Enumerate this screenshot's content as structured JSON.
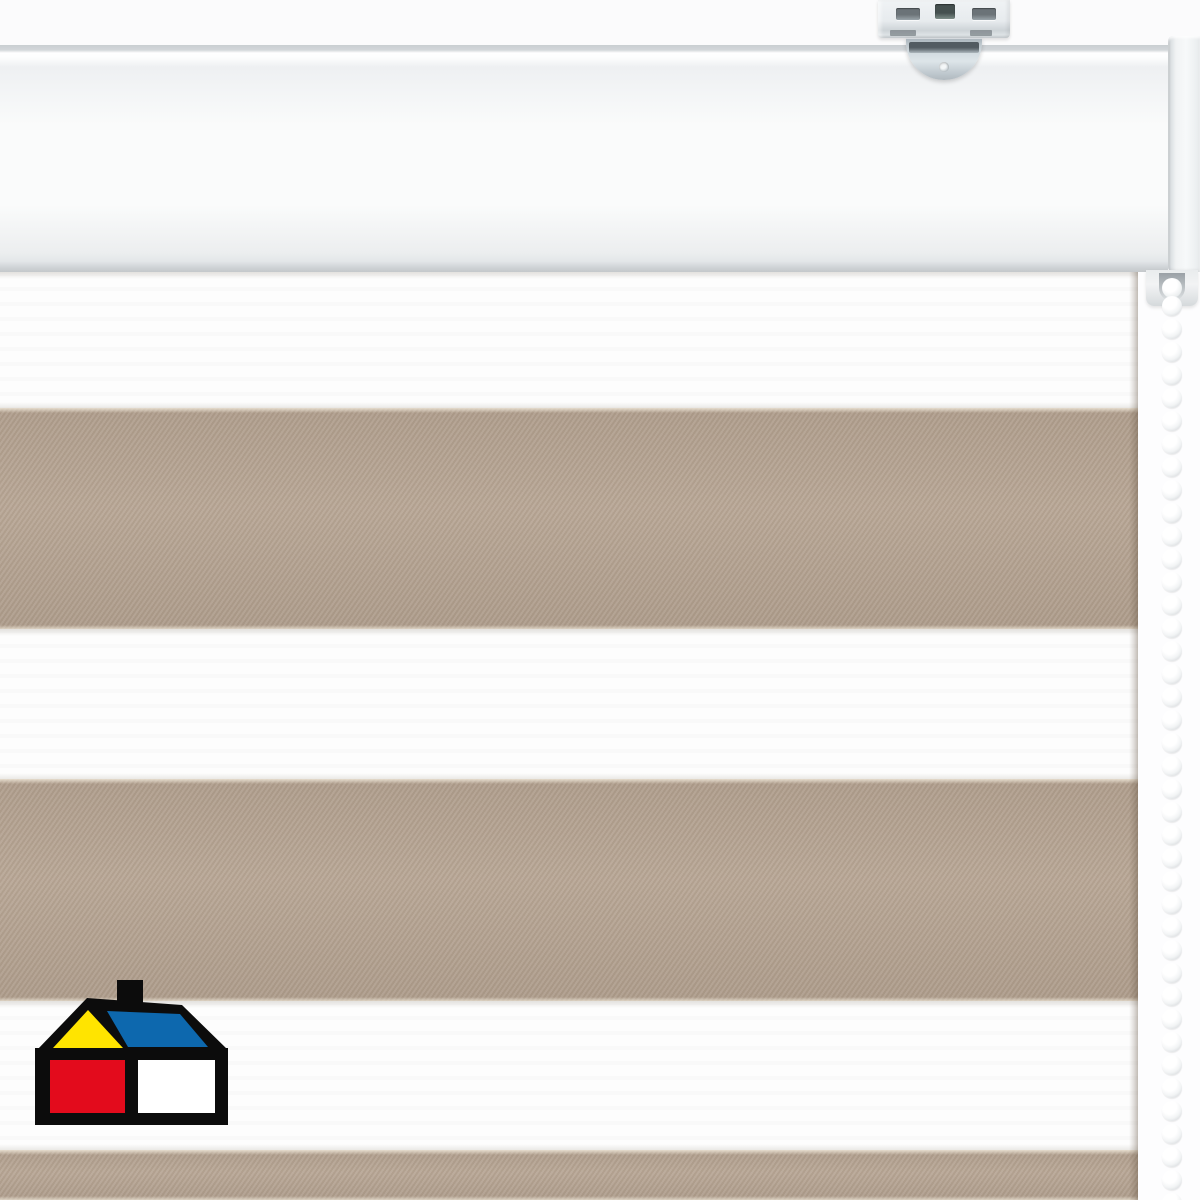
{
  "scene": {
    "subject": "Day-night zebra roller blind with beige and white horizontal stripes, white cassette headrail, metal ceiling-mount bracket, white bead chain and brand house logo at bottom left",
    "background_color": "#fdfdfe",
    "wall_color": "#fbfbfc"
  },
  "headrail": {
    "top_edge_color": "#c9ced1",
    "face_top_color": "#eef0f2",
    "face_mid_color": "#fafbfb",
    "face_bottom_color": "#eceeef",
    "bottom_lip_color": "#cdd1d4",
    "end_cap_color": "#f1f3f4",
    "end_cap_seam_color": "#b9bec2"
  },
  "bracket": {
    "plate_color": "#e7ebee",
    "slot_color": "#6b7378",
    "tab_color": "#c3ccd2",
    "tab_slot_color": "#707a80",
    "tab_hole_color": "#f4f7f8"
  },
  "clutch": {
    "housing_color": "#f2f3f4",
    "shadow_color": "#c2c7ca"
  },
  "chain": {
    "x_center": 1172,
    "start_y": 296,
    "step": 23,
    "bead_diameter": 20,
    "bead_count": 40,
    "bead_color": "#ffffff",
    "bead_shade_color": "#d8dbdd"
  },
  "fabric": {
    "right_edge_x": 1138,
    "beige_color": "#b5a391",
    "white_color": "#fdfdfd",
    "stripes": [
      {
        "tone": "white",
        "top": 272,
        "height": 136
      },
      {
        "tone": "beige",
        "top": 408,
        "height": 221
      },
      {
        "tone": "white",
        "top": 629,
        "height": 150
      },
      {
        "tone": "beige",
        "top": 779,
        "height": 222
      },
      {
        "tone": "white",
        "top": 1001,
        "height": 149
      },
      {
        "tone": "beige",
        "top": 1150,
        "height": 50
      }
    ]
  },
  "logo": {
    "name": "homecenter-house-logo",
    "x": 33,
    "y": 978,
    "width": 197,
    "height": 148,
    "outline_color": "#0c0c0c",
    "roof_front_color": "#ffe400",
    "roof_side_color": "#0d68ae",
    "wall_left_color": "#e30b1c",
    "wall_right_color": "#ffffff"
  }
}
